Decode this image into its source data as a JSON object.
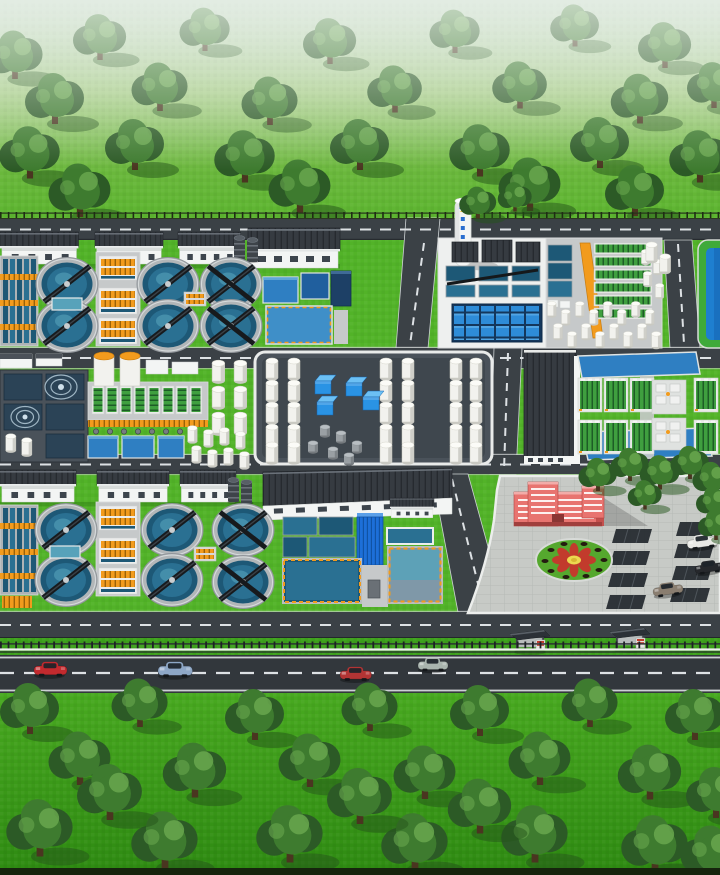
{
  "meta": {
    "title": "Wastewater treatment plant campus — aerial isometric 3D illustration",
    "description": "Computer-rendered bird's-eye view of a water treatment facility: two blocks of six circular clarifiers with scraper bridges, aeration channels, dosing buildings, a stack, settling pools, an orange conveyor ramp, biofilter racks, a fenced white tank farm with blue containers, membrane rack halls between blue basins, a red administration building with flower roundel and parking lot, ring roads, bus shelters, a public highway with traffic, and tree-dotted green belts to the north and south.",
    "canvas": {
      "width": 720,
      "height": 875
    }
  },
  "palette": {
    "haze": "#d3e4d6",
    "grass": "#52b328",
    "verge": "#3da01c",
    "road": "#3b4146",
    "roadDark": "#32373c",
    "roadLine": "#dde1e4",
    "pad": "#c6c9ca",
    "padWhite": "#eef0ef",
    "padDark": "#4a525a",
    "wall": "#f3f5f4",
    "wallShade": "#d7dbda",
    "roof": "#4b5158",
    "roofDark": "#363b41",
    "waterTeal": "#2a7092",
    "waterTealDark": "#1d5876",
    "waterTealLight": "#57a2ba",
    "waterBlue": "#2f7fc2",
    "waterBlueDark": "#205f9e",
    "poolBlue": "#1e7fd0",
    "poolGreen": "#3faa3a",
    "navy": "#1d4066",
    "steel": "#8d969c",
    "tankWhite": "#f2f2ee",
    "tankShade": "#c9c9c2",
    "orange": "#f29b1d",
    "rackGreen": "#3f9f3f",
    "rackSlat": "#1d5c26",
    "cubeBlue": "#2a93e4",
    "cubeBlueLight": "#6cc0f4",
    "treeDark": "#2c5a26",
    "treeMid": "#3e7b2f",
    "treeLight": "#69a74e",
    "trunk": "#4a3520",
    "treeShadow": "#23531a",
    "adminRed": "#e87470",
    "adminRedDark": "#c4504d",
    "flowerRed": "#c23b2c",
    "flowerYellow": "#ecd94f",
    "flowerRing": "#55a82e",
    "bridge": "#171a1d",
    "edgeDark": "#16240d"
  },
  "buildings": {
    "admin": {
      "color": "#e87470"
    }
  },
  "vehicles": {
    "road": [
      {
        "color": "#c22a2e"
      },
      {
        "color": "#8ea7c6"
      },
      {
        "color": "#b23434"
      },
      {
        "color": "#a9b4ae"
      }
    ],
    "parked": [
      {
        "color": "#e9e9e5"
      },
      {
        "color": "#26282c"
      },
      {
        "color": "#8a7e70"
      }
    ]
  },
  "trees": {
    "north": [
      [
        15,
        60,
        1.9
      ],
      [
        100,
        42,
        1.8
      ],
      [
        205,
        34,
        1.7
      ],
      [
        330,
        46,
        1.8
      ],
      [
        455,
        36,
        1.7
      ],
      [
        575,
        30,
        1.65
      ],
      [
        665,
        50,
        1.8
      ],
      [
        55,
        104,
        2.0
      ],
      [
        160,
        92,
        1.9
      ],
      [
        270,
        106,
        1.9
      ],
      [
        395,
        94,
        1.85
      ],
      [
        520,
        90,
        1.85
      ],
      [
        640,
        104,
        1.95
      ],
      [
        714,
        90,
        1.8
      ],
      [
        30,
        158,
        2.05
      ],
      [
        135,
        150,
        2.0
      ],
      [
        245,
        162,
        2.05
      ],
      [
        360,
        150,
        2.0
      ],
      [
        480,
        156,
        2.05
      ],
      [
        600,
        148,
        2.0
      ],
      [
        700,
        162,
        2.05
      ],
      [
        80,
        196,
        2.1
      ],
      [
        300,
        192,
        2.1
      ],
      [
        530,
        190,
        2.1
      ],
      [
        635,
        196,
        2.0
      ]
    ],
    "campus": [
      [
        478,
        206,
        1.25
      ],
      [
        515,
        200,
        1.15
      ],
      [
        598,
        478,
        1.3
      ],
      [
        630,
        468,
        1.3
      ],
      [
        660,
        476,
        1.35
      ],
      [
        690,
        466,
        1.3
      ],
      [
        712,
        482,
        1.3
      ],
      [
        645,
        498,
        1.15
      ],
      [
        714,
        505,
        1.2
      ],
      [
        716,
        528,
        1.2
      ]
    ],
    "south": [
      [
        30,
        714,
        2.0
      ],
      [
        140,
        708,
        1.9
      ],
      [
        255,
        720,
        2.0
      ],
      [
        370,
        712,
        1.9
      ],
      [
        480,
        716,
        2.0
      ],
      [
        590,
        708,
        1.9
      ],
      [
        695,
        720,
        2.0
      ],
      [
        80,
        764,
        2.1
      ],
      [
        195,
        776,
        2.15
      ],
      [
        310,
        766,
        2.1
      ],
      [
        425,
        778,
        2.1
      ],
      [
        540,
        764,
        2.1
      ],
      [
        650,
        778,
        2.15
      ],
      [
        716,
        798,
        2.0
      ],
      [
        40,
        834,
        2.25
      ],
      [
        165,
        846,
        2.25
      ],
      [
        290,
        840,
        2.25
      ],
      [
        415,
        848,
        2.25
      ],
      [
        535,
        840,
        2.25
      ],
      [
        655,
        850,
        2.25
      ],
      [
        712,
        858,
        2.1
      ],
      [
        110,
        798,
        2.2
      ],
      [
        360,
        802,
        2.2
      ],
      [
        480,
        812,
        2.15
      ]
    ]
  },
  "clarifiers": {
    "north": [
      [
        67,
        284
      ],
      [
        67,
        326
      ],
      [
        168,
        284
      ],
      [
        168,
        326
      ]
    ],
    "northX": [
      [
        231,
        284
      ],
      [
        231,
        326
      ]
    ],
    "south": [
      [
        66,
        530
      ],
      [
        66,
        580
      ],
      [
        172,
        530
      ],
      [
        172,
        580
      ]
    ],
    "southX": [
      [
        243,
        530
      ],
      [
        243,
        582
      ]
    ]
  },
  "tanks": {
    "farm": [
      [
        264,
        356
      ],
      [
        286,
        356
      ],
      [
        264,
        378
      ],
      [
        286,
        378
      ],
      [
        264,
        400
      ],
      [
        286,
        400
      ],
      [
        264,
        422
      ],
      [
        286,
        422
      ],
      [
        264,
        440
      ],
      [
        286,
        440
      ],
      [
        378,
        356
      ],
      [
        400,
        356
      ],
      [
        378,
        378
      ],
      [
        400,
        378
      ],
      [
        378,
        400
      ],
      [
        400,
        400
      ],
      [
        378,
        422
      ],
      [
        400,
        422
      ],
      [
        378,
        440
      ],
      [
        400,
        440
      ],
      [
        448,
        356
      ],
      [
        468,
        356
      ],
      [
        448,
        378
      ],
      [
        468,
        378
      ],
      [
        448,
        400
      ],
      [
        468,
        400
      ],
      [
        448,
        422
      ],
      [
        468,
        422
      ],
      [
        448,
        440
      ],
      [
        468,
        440
      ]
    ],
    "east": [
      [
        546,
        300,
        0.72
      ],
      [
        560,
        308,
        0.72
      ],
      [
        574,
        300,
        0.72
      ],
      [
        588,
        308,
        0.72
      ],
      [
        602,
        300,
        0.72
      ],
      [
        616,
        308,
        0.72
      ],
      [
        630,
        300,
        0.72
      ],
      [
        644,
        308,
        0.72
      ],
      [
        552,
        322,
        0.75
      ],
      [
        566,
        330,
        0.75
      ],
      [
        580,
        322,
        0.75
      ],
      [
        594,
        330,
        0.75
      ],
      [
        608,
        322,
        0.75
      ],
      [
        622,
        330,
        0.75
      ],
      [
        636,
        322,
        0.75
      ],
      [
        650,
        330,
        0.78
      ],
      [
        640,
        248,
        0.7
      ],
      [
        652,
        258,
        0.7
      ],
      [
        642,
        270,
        0.7
      ],
      [
        654,
        282,
        0.7
      ],
      [
        644,
        240,
        0.95
      ],
      [
        658,
        252,
        0.9
      ]
    ],
    "bandB": [
      [
        210,
        358,
        1.05
      ],
      [
        232,
        358,
        1.05
      ],
      [
        210,
        384,
        1.05
      ],
      [
        232,
        384,
        1.05
      ],
      [
        210,
        410,
        1.05
      ],
      [
        232,
        410,
        1.05
      ],
      [
        186,
        424,
        0.8
      ],
      [
        202,
        428,
        0.8
      ],
      [
        218,
        426,
        0.8
      ],
      [
        234,
        430,
        0.8
      ],
      [
        190,
        444,
        0.8
      ],
      [
        206,
        448,
        0.8
      ],
      [
        222,
        446,
        0.8
      ],
      [
        238,
        450,
        0.8
      ],
      [
        4,
        432,
        0.85
      ],
      [
        20,
        436,
        0.85
      ]
    ]
  },
  "racks": {
    "bio": [
      [
        594,
        243
      ],
      [
        594,
        256
      ],
      [
        594,
        269
      ],
      [
        594,
        282
      ],
      [
        594,
        295
      ],
      [
        594,
        308
      ]
    ],
    "bandB": [
      [
        92,
        386
      ],
      [
        106,
        386
      ],
      [
        120,
        386
      ],
      [
        134,
        386
      ],
      [
        148,
        386
      ],
      [
        162,
        386
      ],
      [
        176,
        386
      ],
      [
        190,
        386
      ]
    ],
    "membrane": [
      [
        578,
        378
      ],
      [
        604,
        378
      ],
      [
        630,
        378
      ],
      [
        694,
        378
      ],
      [
        578,
        420
      ],
      [
        604,
        420
      ],
      [
        630,
        420
      ],
      [
        694,
        420
      ]
    ]
  },
  "cubes": [
    [
      315,
      375
    ],
    [
      317,
      396
    ],
    [
      346,
      377
    ],
    [
      363,
      391
    ]
  ],
  "drums": [
    [
      320,
      424
    ],
    [
      336,
      430
    ],
    [
      352,
      440
    ],
    [
      308,
      440
    ],
    [
      328,
      446
    ],
    [
      344,
      452
    ]
  ],
  "parking": {
    "stalls": [
      [
        612,
        529
      ],
      [
        610,
        551
      ],
      [
        608,
        573
      ],
      [
        606,
        595
      ],
      [
        676,
        522
      ],
      [
        674,
        544
      ],
      [
        672,
        566
      ],
      [
        670,
        588
      ]
    ]
  },
  "shelters": [
    [
      510,
      628
    ],
    [
      610,
      626
    ]
  ],
  "inventory": {
    "circular_clarifiers": 12,
    "bus_shelters": 2,
    "cars_on_road": 4,
    "cars_parked": 3,
    "tank_farm_silos": 30,
    "flower_roundel": 1
  }
}
